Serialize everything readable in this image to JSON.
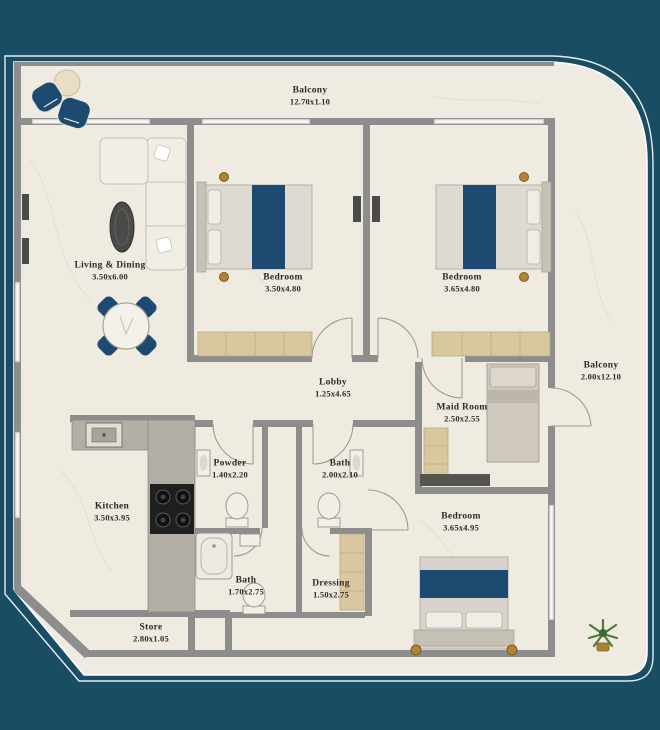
{
  "plan": {
    "title": "Apartment Floor Plan",
    "colors": {
      "background_teal": "#194d63",
      "floor_cream": "#f0ebe1",
      "wall_gray": "#8d8d8d",
      "accent_navy": "#1d4a70",
      "gold": "#b08433",
      "wardrobe_tan": "#d9c7a0"
    },
    "rooms": {
      "balcony_top": {
        "name": "Balcony",
        "dims": "12.70x1.10"
      },
      "living_dining": {
        "name": "Living & Dining",
        "dims": "3.50x6.00"
      },
      "bedroom_1": {
        "name": "Bedroom",
        "dims": "3.50x4.80"
      },
      "bedroom_2": {
        "name": "Bedroom",
        "dims": "3.65x4.80"
      },
      "balcony_right": {
        "name": "Balcony",
        "dims": "2.00x12.10"
      },
      "lobby": {
        "name": "Lobby",
        "dims": "1.25x4.65"
      },
      "maid_room": {
        "name": "Maid Room",
        "dims": "2.50x2.55"
      },
      "powder": {
        "name": "Powder",
        "dims": "1.40x2.20"
      },
      "bath_1": {
        "name": "Bath",
        "dims": "2.00x2.10"
      },
      "kitchen": {
        "name": "Kitchen",
        "dims": "3.50x3.95"
      },
      "bath_2": {
        "name": "Bath",
        "dims": "1.70x2.75"
      },
      "dressing": {
        "name": "Dressing",
        "dims": "1.50x2.75"
      },
      "store": {
        "name": "Store",
        "dims": "2.80x1.05"
      },
      "bedroom_3": {
        "name": "Bedroom",
        "dims": "3.65x4.95"
      }
    }
  }
}
